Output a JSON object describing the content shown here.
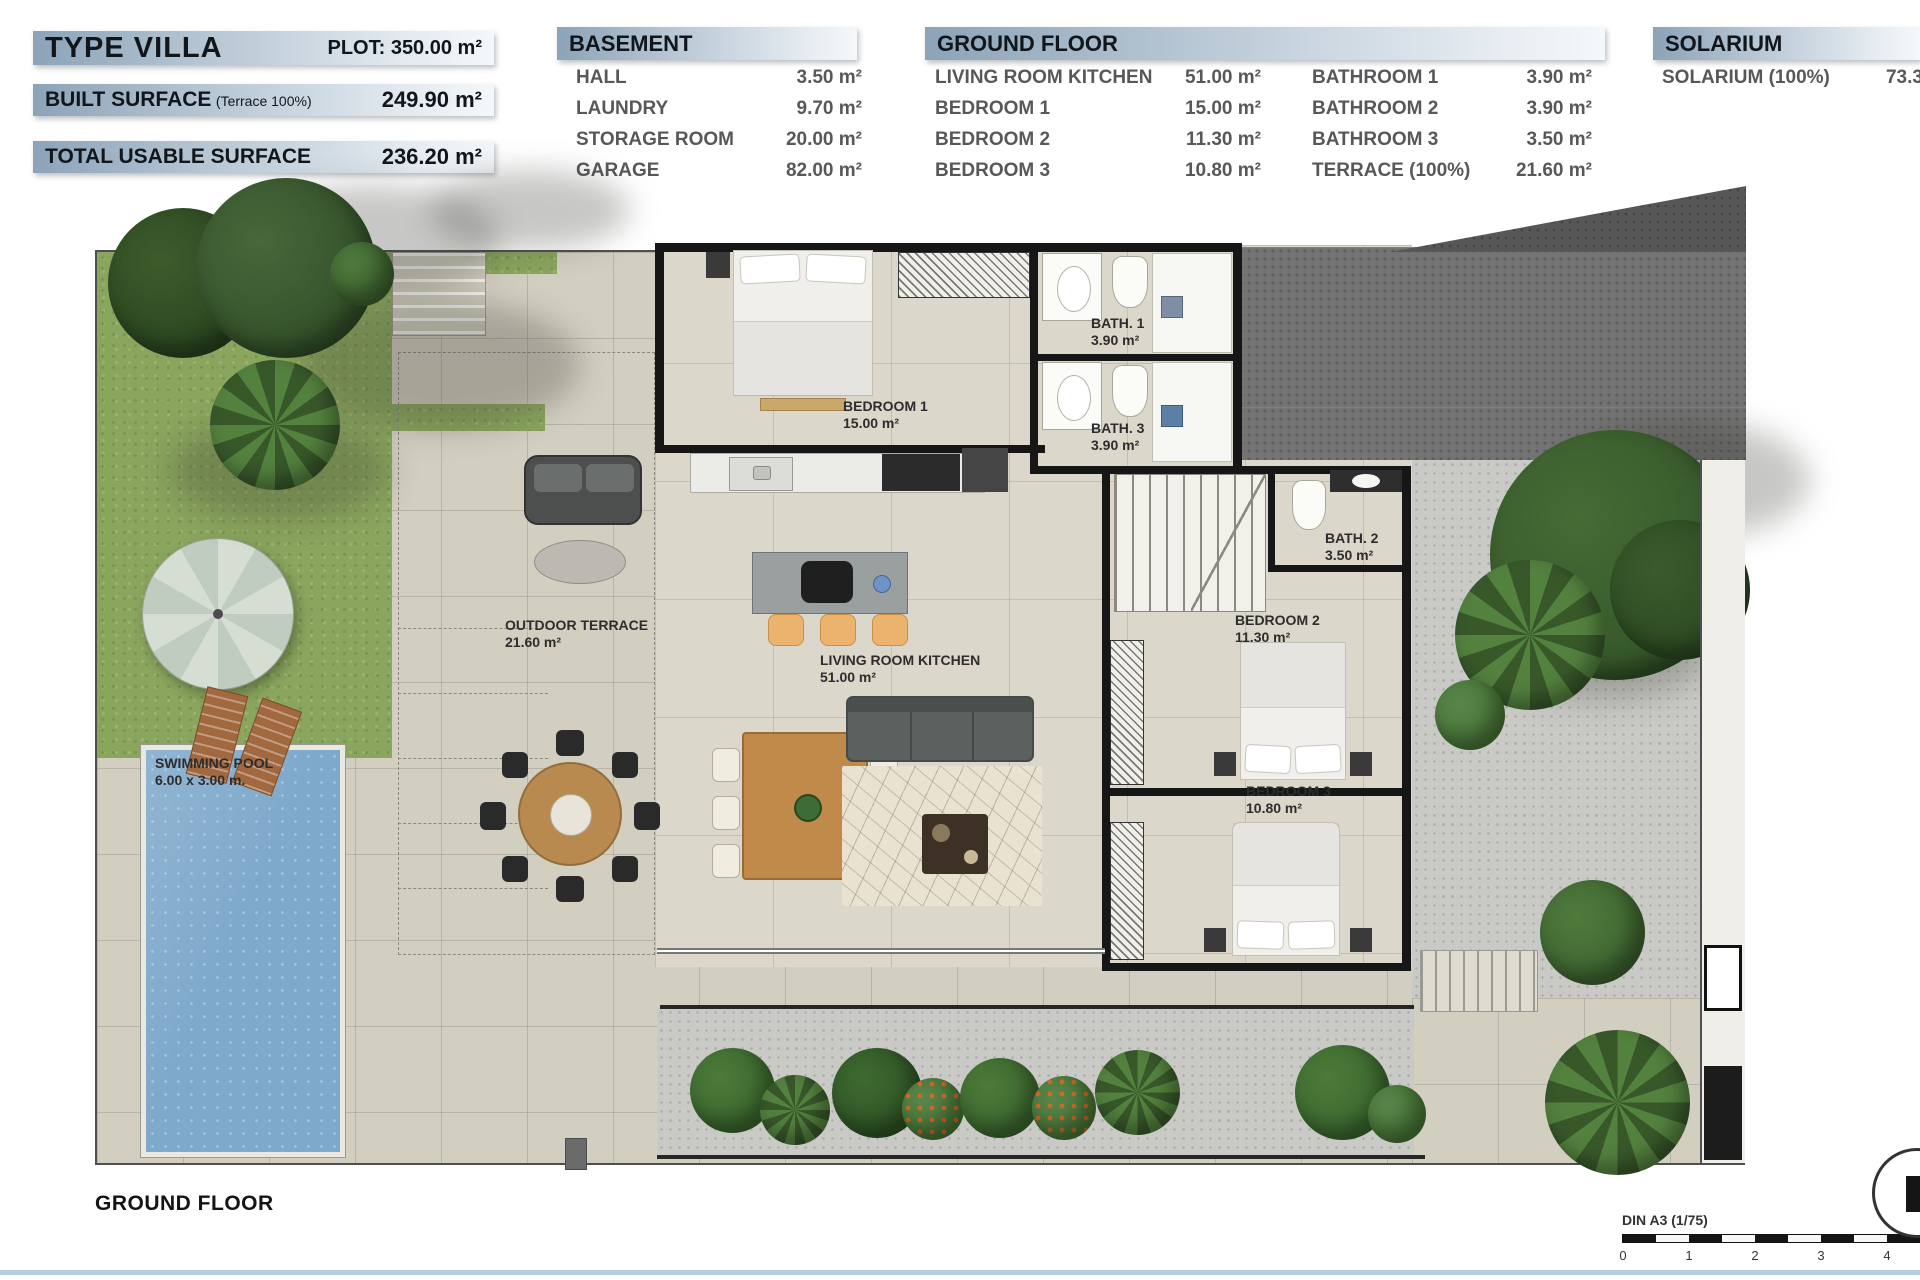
{
  "summary": {
    "title": "TYPE VILLA",
    "plot": "PLOT: 350.00 m²",
    "built_label": "BUILT SURFACE",
    "built_note": "(Terrace 100%)",
    "built_value": "249.90 m²",
    "usable_label": "TOTAL USABLE SURFACE",
    "usable_value": "236.20 m²"
  },
  "basement": {
    "title": "BASEMENT",
    "rows": [
      {
        "label": "HALL",
        "value": "3.50 m²"
      },
      {
        "label": "LAUNDRY",
        "value": "9.70 m²"
      },
      {
        "label": "STORAGE ROOM",
        "value": "20.00 m²"
      },
      {
        "label": "GARAGE",
        "value": "82.00 m²"
      }
    ]
  },
  "ground_floor": {
    "title": "GROUND FLOOR",
    "left_rows": [
      {
        "label": "LIVING ROOM KITCHEN",
        "value": "51.00 m²"
      },
      {
        "label": "BEDROOM 1",
        "value": "15.00 m²"
      },
      {
        "label": "BEDROOM 2",
        "value": "11.30 m²"
      },
      {
        "label": "BEDROOM 3",
        "value": "10.80 m²"
      }
    ],
    "right_rows": [
      {
        "label": "BATHROOM 1",
        "value": "3.90 m²"
      },
      {
        "label": "BATHROOM 2",
        "value": "3.90 m²"
      },
      {
        "label": "BATHROOM 3",
        "value": "3.50 m²"
      },
      {
        "label": "TERRACE (100%)",
        "value": "21.60 m²"
      }
    ]
  },
  "solarium": {
    "title": "SOLARIUM",
    "rows": [
      {
        "label": "SOLARIUM (100%)",
        "value": "73.30 m²"
      }
    ]
  },
  "plan": {
    "bedroom1": {
      "name": "BEDROOM 1",
      "area": "15.00 m²"
    },
    "bath1": {
      "name": "BATH. 1",
      "area": "3.90 m²"
    },
    "bath3": {
      "name": "BATH. 3",
      "area": "3.90 m²"
    },
    "bath2": {
      "name": "BATH. 2",
      "area": "3.50 m²"
    },
    "bedroom2": {
      "name": "BEDROOM 2",
      "area": "11.30 m²"
    },
    "bedroom3": {
      "name": "BEDROOM 3",
      "area": "10.80 m²"
    },
    "living": {
      "name": "LIVING ROOM KITCHEN",
      "area": "51.00 m²"
    },
    "terrace": {
      "name": "OUTDOOR TERRACE",
      "area": "21.60 m²"
    },
    "pool": {
      "name": "SWIMMING POOL",
      "area": "6.00 x 3.00 m."
    }
  },
  "footer": {
    "title": "GROUND FLOOR",
    "scale_label": "DIN A3 (1/75)",
    "ticks": [
      "0",
      "1",
      "2",
      "3",
      "4"
    ]
  },
  "colors": {
    "accent_bar": "#9db2c6",
    "grass": "#8aa55e",
    "pool": "#7fa9cb",
    "gravel": "#c9c9c5",
    "driveway": "#747474"
  }
}
